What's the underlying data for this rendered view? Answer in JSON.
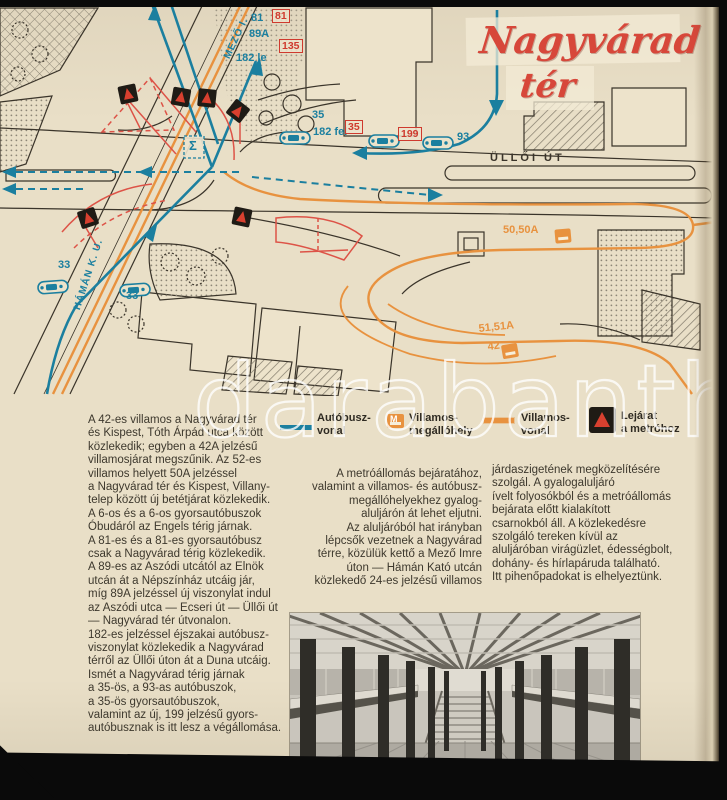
{
  "scan": {
    "watermark": "darabanth"
  },
  "title": {
    "line1": "Nagyvárad",
    "line2": "tér"
  },
  "map": {
    "streets": {
      "ulloi": "ÜLLŐI ÚT",
      "mezo_imre": "MEZŐ I.",
      "haman_kato": "HÁMÁN K. U."
    },
    "labels": {
      "r81": "81",
      "r81_gyors": "81",
      "r89a": "89A",
      "r135_gyors": "135",
      "r182_le": "182 le",
      "r35": "35",
      "r182_fel": "182 fel",
      "r35_gyors": "35",
      "r199_gyors": "199",
      "r93": "93",
      "r50_50a": "50,50A",
      "r51_51a": "51,51A",
      "r42": "42",
      "r33_a": "33",
      "r33_b": "33",
      "sigma": "Σ"
    },
    "icons": {
      "metro_entrance": "metro-entrance-icon",
      "bus_stop": "bus-stop-icon",
      "tram_stop": "tram-stop-icon"
    }
  },
  "legend": {
    "bus_line": "Autóbusz-\nvonal",
    "tram_stop": "Villamos-\nmegállóhely",
    "tram_line": "Villamos-\nvonal",
    "metro_exit": "Lejárat\na metróhoz"
  },
  "columns": {
    "left": "A 42-es villamos a Nagyvárad tér\nés Kispest, Tóth Árpád utca között\nközlekedik; egyben a 42A jelzésű\nvillamosjárat megszűnik. Az 52-es\nvillamos helyett 50A jelzéssel\na Nagyvárad tér és Kispest, Villany-\ntelep között új betétjárat közlekedik.\nA 6-os és a 6-os gyorsautóbuszok\nÓbudáról az Engels térig járnak.\nA 81-es és a 81-es gyorsautóbusz\ncsak a Nagyvárad térig közlekedik.\nA 89-es az Aszódi utcától az Elnök\nutcán át a Népszínház utcáig jár,\nmíg 89A jelzéssel új viszonylat indul\naz Aszódi utca — Ecseri út — Üllői út\n— Nagyvárad tér útvonalon.\n182-es jelzéssel éjszakai autóbusz-\nviszonylat közlekedik a Nagyvárad\ntérről az Üllői úton át a Duna utcáig.\nIsmét a Nagyvárad térig járnak\na 35-ös, a 93-as autóbuszok,\na 35-ös gyorsautóbuszok,\nvalamint az új, 199 jelzésű gyors-\nautóbusznak is itt lesz a végállomása.",
    "middle": "A metróállomás bejáratához,\nvalamint a villamos- és autóbusz-\nmegállóhelyekhez gyalog-\naluljárón át lehet eljutni.\nAz aluljáróból hat irányban\nlépcsők vezetnek a Nagyvárad\ntérre, közülük kettő a Mező Imre\núton — Hámán Kató utcán\nközlekedő 24-es jelzésű villamos",
    "right": "járdaszigetének megközelítésére\nszolgál. A gyalogaluljáró\nívelt folyosókból és a metróállomás\nbejárata előtt kialakított\ncsarnokból áll. A közlekedésre\nszolgáló tereken kívül az\naluljáróban virágüzlet, édességbolt,\ndohány- és hírlapáruda található.\nItt pihenőpadokat is elhelyeztünk."
  }
}
